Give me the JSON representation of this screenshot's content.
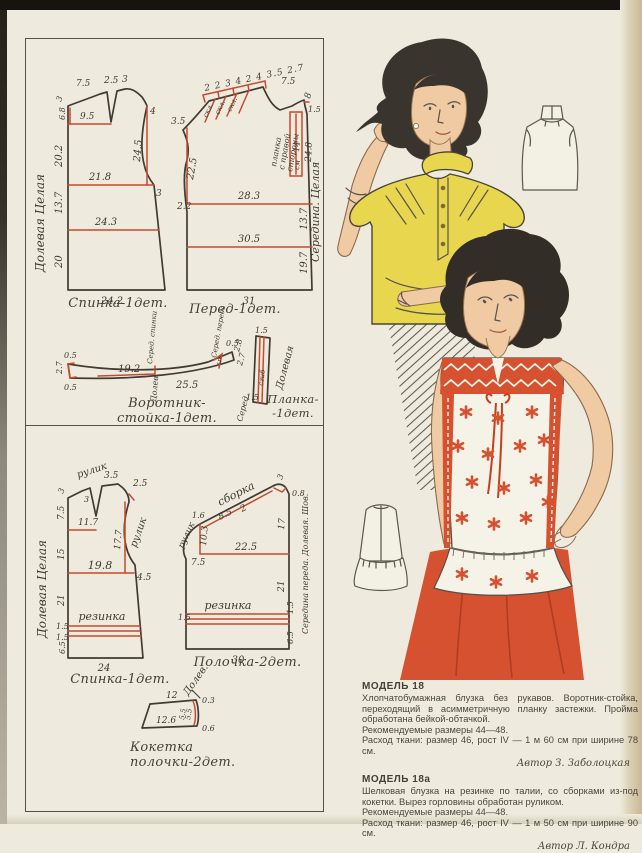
{
  "colors": {
    "paper": "#eeebde",
    "ink": "#403b34",
    "pattern_red": "#c64b2e",
    "blouse_yellow": "#e9d64f",
    "accent_red": "#d5512f",
    "skin": "#f0caa2",
    "hair": "#332d28"
  },
  "patterns": {
    "back18": {
      "caption": "Спинка-1дет.",
      "grain": "Долевая Целая",
      "shoulder": "7.5",
      "dart": "2.5",
      "neck": "3",
      "edge": "3",
      "dart_depth": "6.8",
      "dart_len": "9.5",
      "upper": "20.2",
      "armhole": "24.5",
      "armhole_top": "4",
      "chest": "21.8",
      "side": "3",
      "waist": "13.7",
      "hip": "24.3",
      "lower": "20",
      "hem": "24.2"
    },
    "front18": {
      "caption": "Перед-1дет.",
      "center": "Середина. Целая",
      "placket1": "планка",
      "placket2": "с правой",
      "placket3": "стороны",
      "placket_cm": "см",
      "placket_len": "14",
      "pleat1": "скл.",
      "pleat2": "скл.",
      "pleat3": "скл.",
      "top_seq": "2 2 3 4 2 4 3.5 2.7",
      "shoulder": "7.5",
      "neck_l": "3.5",
      "armhole": "22.5",
      "top_r": "8",
      "notch": "1.5",
      "placket_depth": "24.8",
      "chest": "28.3",
      "step": "2.2",
      "waist": "13.7",
      "hip": "30.5",
      "lower": "19.7",
      "hem": "31"
    },
    "collar": {
      "caption": "Воротник-стойка-1дет.",
      "cb": "Серед. спинки",
      "grain": "Долев.",
      "cf": "Серед. переда",
      "lt": "0.5",
      "lh": "2.7",
      "lb": "0.5",
      "seg1": "19.2",
      "seg2": "25.5",
      "rt": "0.5",
      "wedge": "5",
      "r1": "2.8",
      "r2": "2.7"
    },
    "planka": {
      "caption1": "Планка-",
      "caption2": "-1дет.",
      "grain": "Долевая",
      "fold": "сгиб",
      "center": "Серед.",
      "t": "1.5",
      "b": "1.5"
    },
    "back18a": {
      "caption": "Спинка-1дет.",
      "grain": "Долевая Целая",
      "rouleau1": "рулик",
      "rouleau2": "рулик",
      "elastic": "резинка",
      "edge": "3",
      "dart_l": "3",
      "dart_w": "3.5",
      "neck_r": "2.5",
      "upper": "7.5",
      "dart_line": "11.7",
      "mid": "15",
      "armhole": "17.7",
      "chest": "19.8",
      "side": "4.5",
      "lower": "21",
      "el1": "1.5",
      "el2": "1.5",
      "hem_l": "6.5",
      "hem": "24"
    },
    "front18a": {
      "caption": "Полочка-2дет.",
      "center": "Середина переда. Долевая. Шов.",
      "gather": "сборка",
      "rouleau": "рулик",
      "elastic": "резинка",
      "neck_l": "1.6",
      "shoulder": "8.5",
      "sh2": "2",
      "top_r": "3",
      "top_r2": "0.8",
      "arm_v": "10.3",
      "right1": "17",
      "chest": "22.5",
      "notch": "7.5",
      "lower": "21",
      "el1": "1.5",
      "el2": "1.5",
      "hem_r": "6.5",
      "hem": "30"
    },
    "yoke": {
      "caption1": "Кокетка",
      "caption2": "полочки-2дет.",
      "grain": "Долев.",
      "top": "12",
      "bottom": "12.6",
      "h1": "5.5",
      "h2": "5.5",
      "rt": "0.3",
      "rb": "0.6"
    }
  },
  "info": {
    "model18": {
      "title": "МОДЕЛЬ 18",
      "body": "Хлопчатобумажная блузка без рукавов. Воротник-стойка, переходящий в асимметричную планку застежки. Пройма обработана бейкой-обтачкой.",
      "sizes": "Рекомендуемые размеры 44—48.",
      "fabric": "Расход ткани: размер 46, рост IV — 1 м 60 см при ширине 78 см.",
      "author": "Автор З. Заболоцкая"
    },
    "model18a": {
      "title": "МОДЕЛЬ 18а",
      "body": "Шелковая блузка на резинке по талии, со сборками из-под кокетки. Вырез горловины обработан руликом.",
      "sizes": "Рекомендуемые размеры 44—48.",
      "fabric": "Расход ткани: размер 46, рост IV — 1 м 50 см при ширине 90 см.",
      "author": "Автор Л. Кондра"
    }
  }
}
